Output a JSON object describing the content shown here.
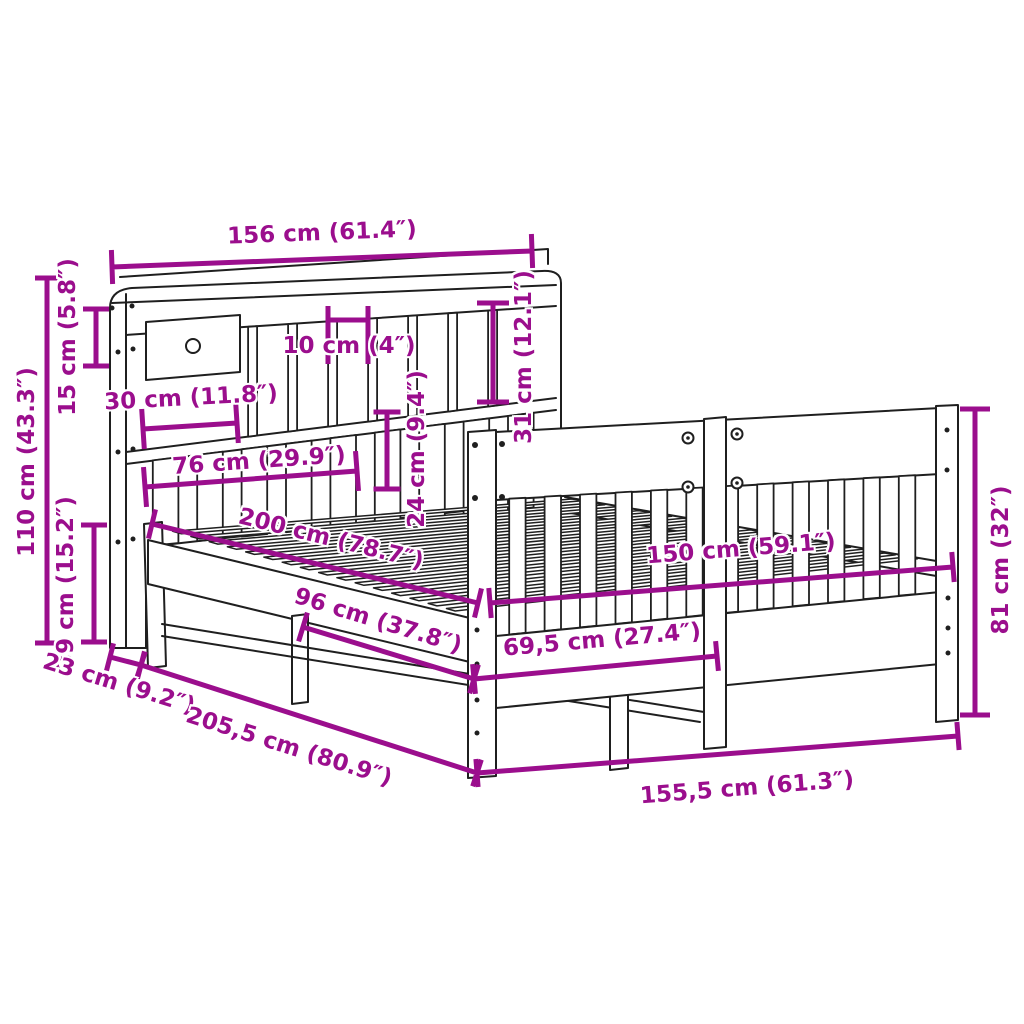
{
  "diagram": {
    "title": "Bed frame with bookcase headboard — dimension diagram",
    "accent_color": "#9b0e8d",
    "line_color": "#1f1f1f",
    "background_color": "#ffffff"
  },
  "dimensions": {
    "headboard_width": "156 cm (61.4″)",
    "total_height": "110 cm (43.3″)",
    "top_shelf_height": "15 cm (5.8″)",
    "lower_section_height": "39 cm (15.2″)",
    "base_depth": "23 cm (9.2″)",
    "total_length": "205,5 cm (80.9″)",
    "total_width": "155,5 cm (61.3″)",
    "inner_length": "200 cm (78.7″)",
    "inner_width": "150 cm (59.1″)",
    "compartment_width": "10 cm (4″)",
    "drawer_width": "30 cm (11.8″)",
    "slat_panel_width": "76 cm (29.9″)",
    "shelf_opening_height": "31 cm (12.1″)",
    "slat_height": "24 cm (9.4″)",
    "rail_span": "96 cm (37.8″)",
    "footboard_span": "69,5 cm (27.4″)",
    "footboard_height": "81 cm (32″)"
  }
}
